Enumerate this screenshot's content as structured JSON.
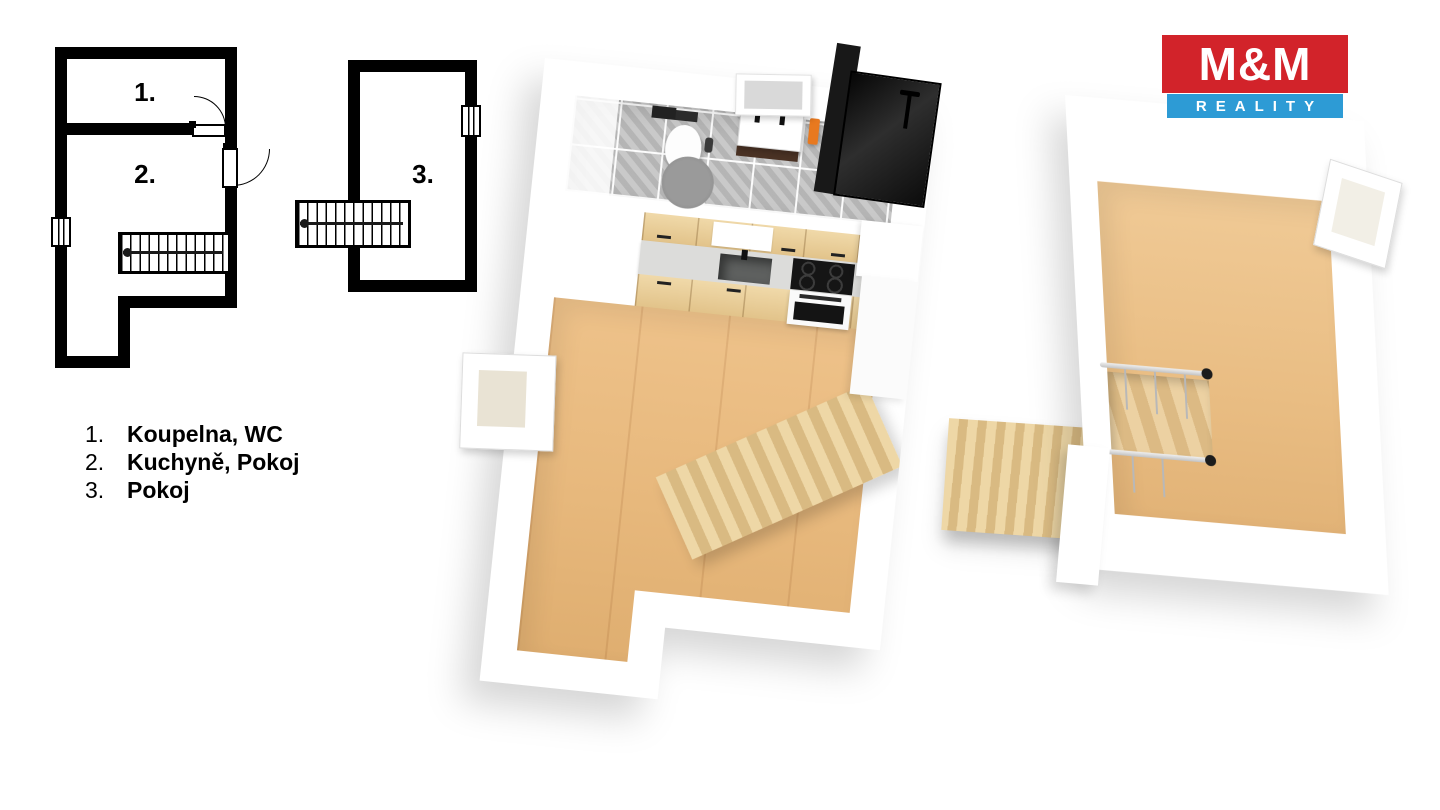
{
  "page": {
    "width": 1440,
    "height": 810,
    "background": "#ffffff"
  },
  "branding": {
    "logo_text": "M&M",
    "logo_subtext": "REALITY",
    "logo_red": "#d2232a",
    "logo_blue": "#2d9bd5"
  },
  "floorplan_2d": {
    "building_left": {
      "room1_label": "1.",
      "room2_label": "2."
    },
    "building_right": {
      "room3_label": "3."
    }
  },
  "legend": {
    "items": [
      {
        "num": "1.",
        "label": "Koupelna, WC"
      },
      {
        "num": "2.",
        "label": "Kuchyně, Pokoj"
      },
      {
        "num": "3.",
        "label": "Pokoj"
      }
    ]
  },
  "colors": {
    "plan_wall": "#000000",
    "wood_floor": "#e7bd85",
    "wood_stairs": "#e6cfa0",
    "bathroom_tile": "#c9c9c9",
    "shower_glass": "#161616",
    "towel_orange": "#e8791f",
    "vanity_brown": "#4a3224",
    "rug_gray": "#8e8e8e"
  }
}
